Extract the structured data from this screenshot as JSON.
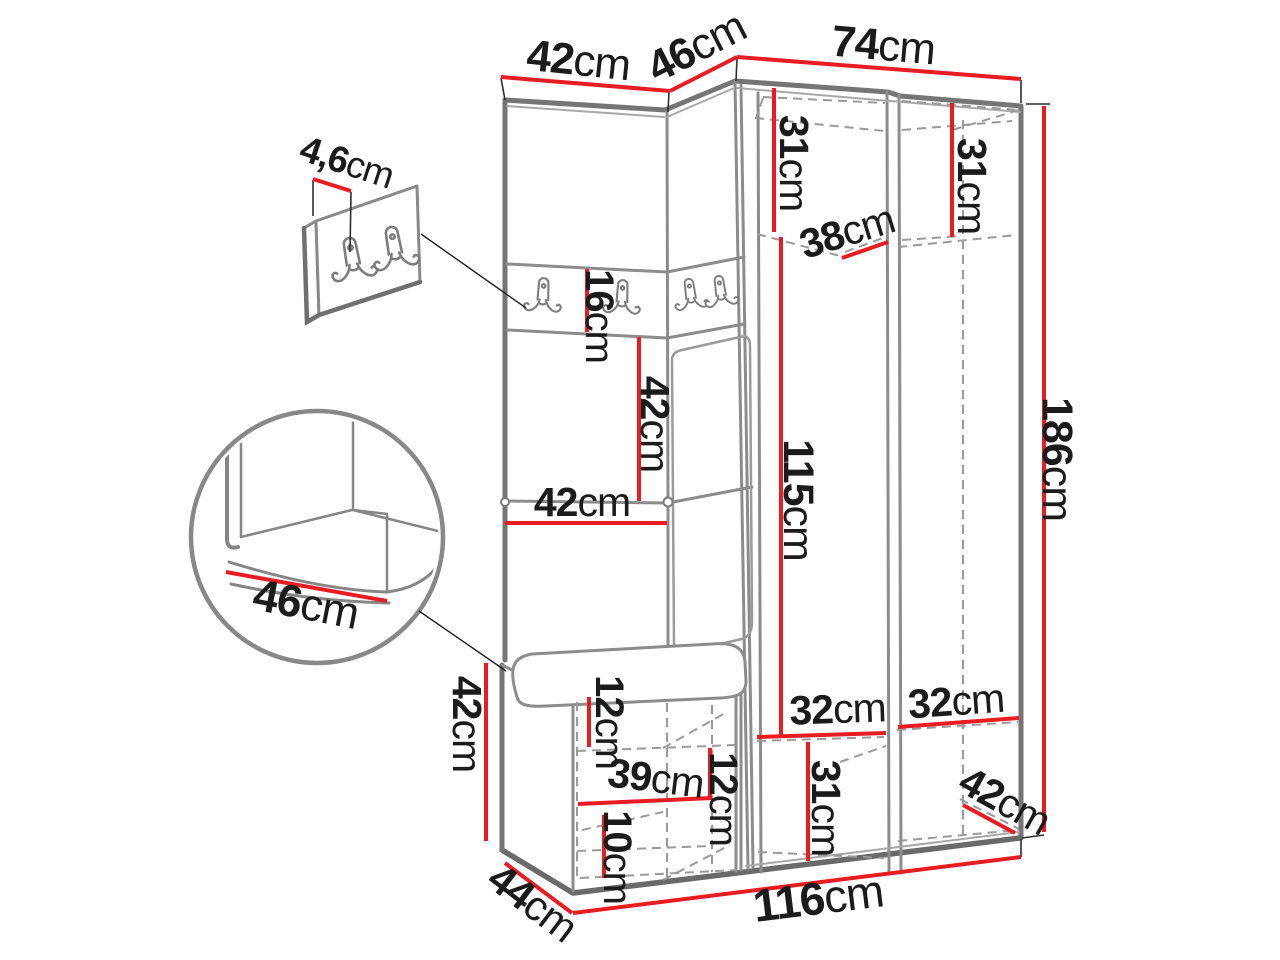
{
  "figure": {
    "type": "furniture-dimension-diagram",
    "unit": "cm"
  },
  "colors": {
    "dimension_line": "#e81d23",
    "outline": "#757575",
    "outline_light": "#8c8c8c",
    "text": "#1b1b1b"
  },
  "labels": {
    "top_width_left": {
      "v": "42",
      "u": "cm"
    },
    "top_width_angled": {
      "v": "46",
      "u": "cm"
    },
    "top_width_right": {
      "v": "74",
      "u": "cm"
    },
    "hook_panel_offset": {
      "v": "4,6",
      "u": "cm"
    },
    "upper_left_height": {
      "v": "31",
      "u": "cm"
    },
    "upper_right_height": {
      "v": "31",
      "u": "cm"
    },
    "top_shelf_depth": {
      "v": "38",
      "u": "cm"
    },
    "hook_strip_height": {
      "v": "16",
      "u": "cm"
    },
    "mid_opening_height": {
      "v": "42",
      "u": "cm"
    },
    "left_panel_width": {
      "v": "42",
      "u": "cm"
    },
    "door_height": {
      "v": "115",
      "u": "cm"
    },
    "total_height": {
      "v": "186",
      "u": "cm"
    },
    "bench_detail_depth": {
      "v": "46",
      "u": "cm"
    },
    "bottom_shelf_left_width": {
      "v": "32",
      "u": "cm"
    },
    "bottom_shelf_right_width": {
      "v": "32",
      "u": "cm"
    },
    "bottom_left_height": {
      "v": "31",
      "u": "cm"
    },
    "bottom_right_depth": {
      "v": "42",
      "u": "cm"
    },
    "bench_height": {
      "v": "42",
      "u": "cm"
    },
    "bench_top_gap": {
      "v": "12",
      "u": "cm"
    },
    "bench_shelf_width": {
      "v": "39",
      "u": "cm"
    },
    "bench_mid_gap": {
      "v": "12",
      "u": "cm"
    },
    "bench_bottom_gap": {
      "v": "10",
      "u": "cm"
    },
    "bench_depth": {
      "v": "44",
      "u": "cm"
    },
    "total_width": {
      "v": "116",
      "u": "cm"
    }
  }
}
